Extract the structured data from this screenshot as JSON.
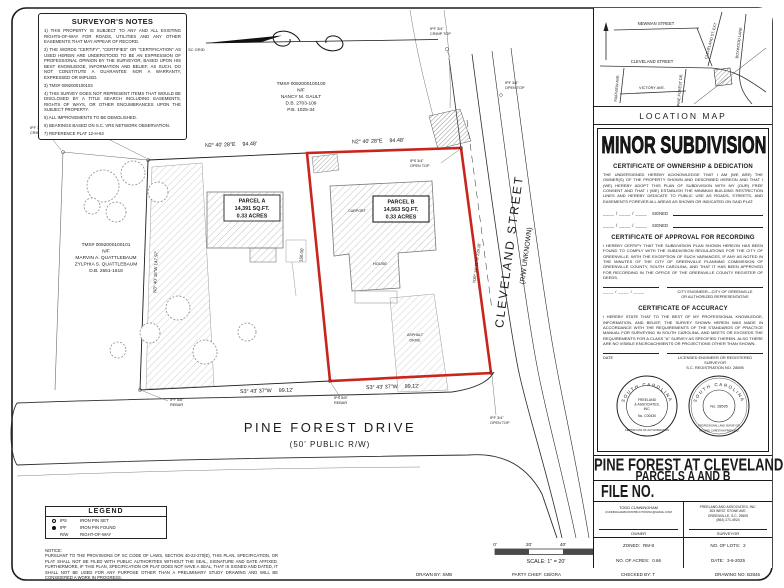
{
  "notes": {
    "title": "SURVEYOR'S NOTES",
    "items": [
      "1) THIS PROPERTY IS SUBJECT TO ANY AND ALL EXISTING RIGHTS-OF-WAY FOR ROADS, UTILITIES AND ANY OTHER EASEMENTS THAT MAY APPEAR OF RECORD.",
      "2) THE WORDS \"CERTIFY\", \"CERTIFIES\" OR \"CERTIFICATION\" AS USED HEREIN ARE UNDERSTOOD TO BE AN EXPRESSION OF PROFESSIONAL OPINION BY THE SURVEYOR, BASED UPON HIS BEST KNOWLEDGE, INFORMATION AND BELIEF, AS SUCH, DO NOT CONSTITUTE A GUARANTEE NOR A WARRANTY, EXPRESSED OR IMPLIED.",
      "3) TMS# 0092000100103",
      "4) THIS SURVEY DOES NOT REPRESENT ITEMS THAT WOULD BE DISCLOSED BY A TITLE SEARCH INCLUDING EASEMENTS, RIGHTS OF WAYS, OR OTHER ENCUMBRANCES UPON THE SUBJECT PROPERTY.",
      "5) ALL IMPROVEMENTS TO BE DEMOLISHED.",
      "6) BEARINGS BASED ON S.C. VRS NETWORK OBSERVATION.",
      "7) REFERENCE PLAT 12-H-63"
    ]
  },
  "location_map": {
    "label": "LOCATION MAP",
    "streets": {
      "newman": "NEWMAN STREET",
      "cleveland": "CLEVELAND STREET",
      "fairview": "FAIRVIEW AVE.",
      "victory": "VICTORY AVE.",
      "pine_forest": "PINE FOREST DR.",
      "cleveland_ext": "CLEVELAND ST. EXT.",
      "boxwood": "BOXWOOD LANE"
    }
  },
  "subdivision": {
    "title": "MINOR SUBDIVISION",
    "cert_ownership": {
      "title": "CERTIFICATE OF OWNERSHIP & DEDICATION",
      "body": "THE UNDERSIGNED HEREBY ACKNOWLEDGE THAT I AM (WE ARE) THE OWNER(S) OF THE PROPERTY SHOWN AND DESCRIBED HEREON AND THAT I (WE) HEREBY ADOPT THIS PLAN OF SUBDIVISION WITH MY (OUR) FREE CONSENT AND THAT I (WE) ESTABLISH THE MINIMUM BUILDING RESTRICTION LINES AND HEREBY DEDICATE TO PUBLIC USE AS ROADS, STREETS, AND EASEMENTS FOREVER ALL AREAS AS SHOWN OR INDICATED ON SAID PLAT.",
      "date_line": "____ / ____ / ____",
      "signed_label": "SIGNED"
    },
    "cert_recording": {
      "title": "CERTIFICATE OF APPROVAL FOR RECORDING",
      "body": "I HEREBY CERTIFY THAT THE SUBDIVISION PLAN SHOWN HEREON HAS BEEN FOUND TO COMPLY WITH THE SUBDIVISION REGULATIONS FOR THE CITY OF GREENVILLE, WITH THE EXCEPTION OF SUCH VARIANCES, IF ANY AS NOTED IN THE MINUTES OF THE CITY OF GREENVILLE PLANNING COMMISSION OF GREENVILLE COUNTY, SOUTH CAROLINA, AND THAT IT HAS BEEN APPROVED FOR RECORDING IN THE OFFICE OF THE GREENVILLE COUNTY REGISTER OF DEEDS.",
      "date_line": "____ / ____ / ____",
      "sig_line1": "CITY ENGINEER—CITY OF GREENVILLE",
      "sig_line2": "OR AUTHORIZED REPRESENTATIVE"
    },
    "cert_accuracy": {
      "title": "CERTIFICATE OF ACCURACY",
      "body": "I HEREBY STATE THAT TO THE BEST OF MY PROFESSIONAL KNOWLEDGE, INFORMATION, AND BELIEF, THE SURVEY SHOWN HEREIN WAS MADE IN ACCORDANCE WITH THE REQUIREMENTS OF THE STANDARDS OF PRACTICE MANUAL FOR SURVEYING IN SOUTH CAROLINA, AND MEETS OR EXCEEDS THE REQUIREMENTS FOR A CLASS \"A\" SURVEY AS SPECIFIED THEREIN. ALSO THERE ARE NO VISIBLE ENCROACHMENTS OR PROJECTIONS OTHER THAN SHOWN."
    },
    "date_label": "DATE",
    "surveyor_sig_line1": "LICENSED ENGINEER OR REGISTERED SURVEYOR",
    "surveyor_sig_line2": "S.C. REGISTRATION NO. 28595"
  },
  "seals": {
    "auth": {
      "ring_top": "SOUTH CAROLINA",
      "ring_bottom": "CERTIFICATE OF AUTHORIZATION",
      "line1": "FREELAND",
      "line2": "& ASSOCIATES,",
      "line3": "INC.",
      "line4": "No. C00430"
    },
    "surveyor": {
      "ring_top": "SOUTH CAROLINA",
      "ring_mid": "PROFESSIONAL LAND SURVEYOR",
      "ring_bottom": "MICHAEL CHRISTIAN FREELAND",
      "number": "No. 28595"
    }
  },
  "title_block": {
    "project_line1": "PINE FOREST AT CLEVELAND",
    "project_line2": "PARCELS A AND B",
    "file_label": "FILE NO.",
    "owner": {
      "name": "TODD CUNNINGHAM",
      "email": "CUNNINGHAMCONSTRUCTIONSC@GMAIL.COM",
      "label": "OWNER"
    },
    "surveyor": {
      "line1": "FREELAND AND ASSOCIATES, INC.",
      "line2": "303 WEST STONE AVE.",
      "line3": "GREENVILLE, S.C. 29609",
      "line4": "(864) 271-4924",
      "label": "SURVEYOR"
    },
    "zoned_label": "ZONED:",
    "zoned_value": "RM-8",
    "lots_label": "NO. OF LOTS:",
    "lots_value": "2",
    "acres_label": "NO. OF ACRES:",
    "acres_value": "0.66",
    "date_label": "DATE:",
    "date_value": "3-6-2025"
  },
  "legend": {
    "title": "LEGEND",
    "rows": [
      {
        "abbr": "IPS",
        "desc": "IRON PIN SET"
      },
      {
        "abbr": "IPF",
        "desc": "IRON PIN FOUND"
      },
      {
        "abbr": "R/W",
        "desc": "RIGHT-OF-WAY"
      }
    ]
  },
  "notice": {
    "title": "NOTICE:",
    "body": "PURSUANT TO THE PROVISIONS OF SC CODE OF LAWS, SECTION 40-22-270(E), THIS PLAN, SPECIFICATION, OR PLAT SHALL NOT BE FILED WITH PUBLIC AUTHORITIES WITHOUT THE SEAL, SIGNATURE AND DATE AFFIXED. FURTHERMORE, IF THIS PLAN, SPECIFICATION OR PLAT DOES NOT HAVE A SEAL, THAT IS SIGNED AND DATED, IT SHALL NOT BE USED FOR ANY PURPOSE OTHER THAN A PRELIMINARY STUDY DRAWING AND WILL BE CONSIDERED A WORK IN PROGRESS."
  },
  "scale_bar": {
    "t0": "0'",
    "t20": "20'",
    "t40": "40'",
    "t60": "60'",
    "label": "SCALE: 1\" = 20'"
  },
  "strip": {
    "drawn": "DRAWN BY: SMB",
    "chief": "PARTY CHIEF: CB/GRA",
    "checked": "CHECKED BY: T",
    "drawing_no": "DRAWING NO: B2845"
  },
  "plat": {
    "gault": [
      "TMS# 0092000100100",
      "N/F",
      "NANCY M. GAULT",
      "D.B. 2703-109",
      "P.B. 1025-34"
    ],
    "quattlebaum": [
      "TMS# 0092000100101",
      "N/F",
      "MARVIN A. QUATTLEBAUM",
      "ZYLPHIA S. QUATTLEBAUM",
      "D.B. 2551-1618"
    ],
    "parcel_a": [
      "PARCEL A",
      "14,391 SQ.FT.",
      "0.33 ACRES"
    ],
    "parcel_b": [
      "PARCEL B",
      "14,563 SQ.FT.",
      "0.33 ACRES"
    ],
    "street_main": "PINE FOREST DRIVE",
    "street_main_sub": "(50' PUBLIC R/W)",
    "street_side": "CLEVELAND STREET",
    "street_side_sub": "(R/W UNKNOWN)",
    "bearing_top": "N2° 40' 28\"E",
    "len_top": "94.48'",
    "bearing_bottom": "S3° 43' 37\"W",
    "len_bottom": "99.12'",
    "bearing_west": "N3° 40' 16\"W  147.97'",
    "len_red_left": "150.00'",
    "bearing_cleveland": "N39° 34' 51\"W  229.16'",
    "north_label": "SC GRID",
    "markers": {
      "ipf34": "IPF 3/4\"",
      "ips34": "IPS 3/4\"",
      "ips58": "IPS 5/8\"",
      "ipf58": "IPF 5/8\"",
      "crimp": "CRIMP TOP",
      "open": "OPEN TOP",
      "rebar": "REBAR"
    },
    "house_label": "HOUSE",
    "carport_label": "CARPORT",
    "asphalt1": "ASPHALT",
    "asphalt2": "DRIVE"
  }
}
